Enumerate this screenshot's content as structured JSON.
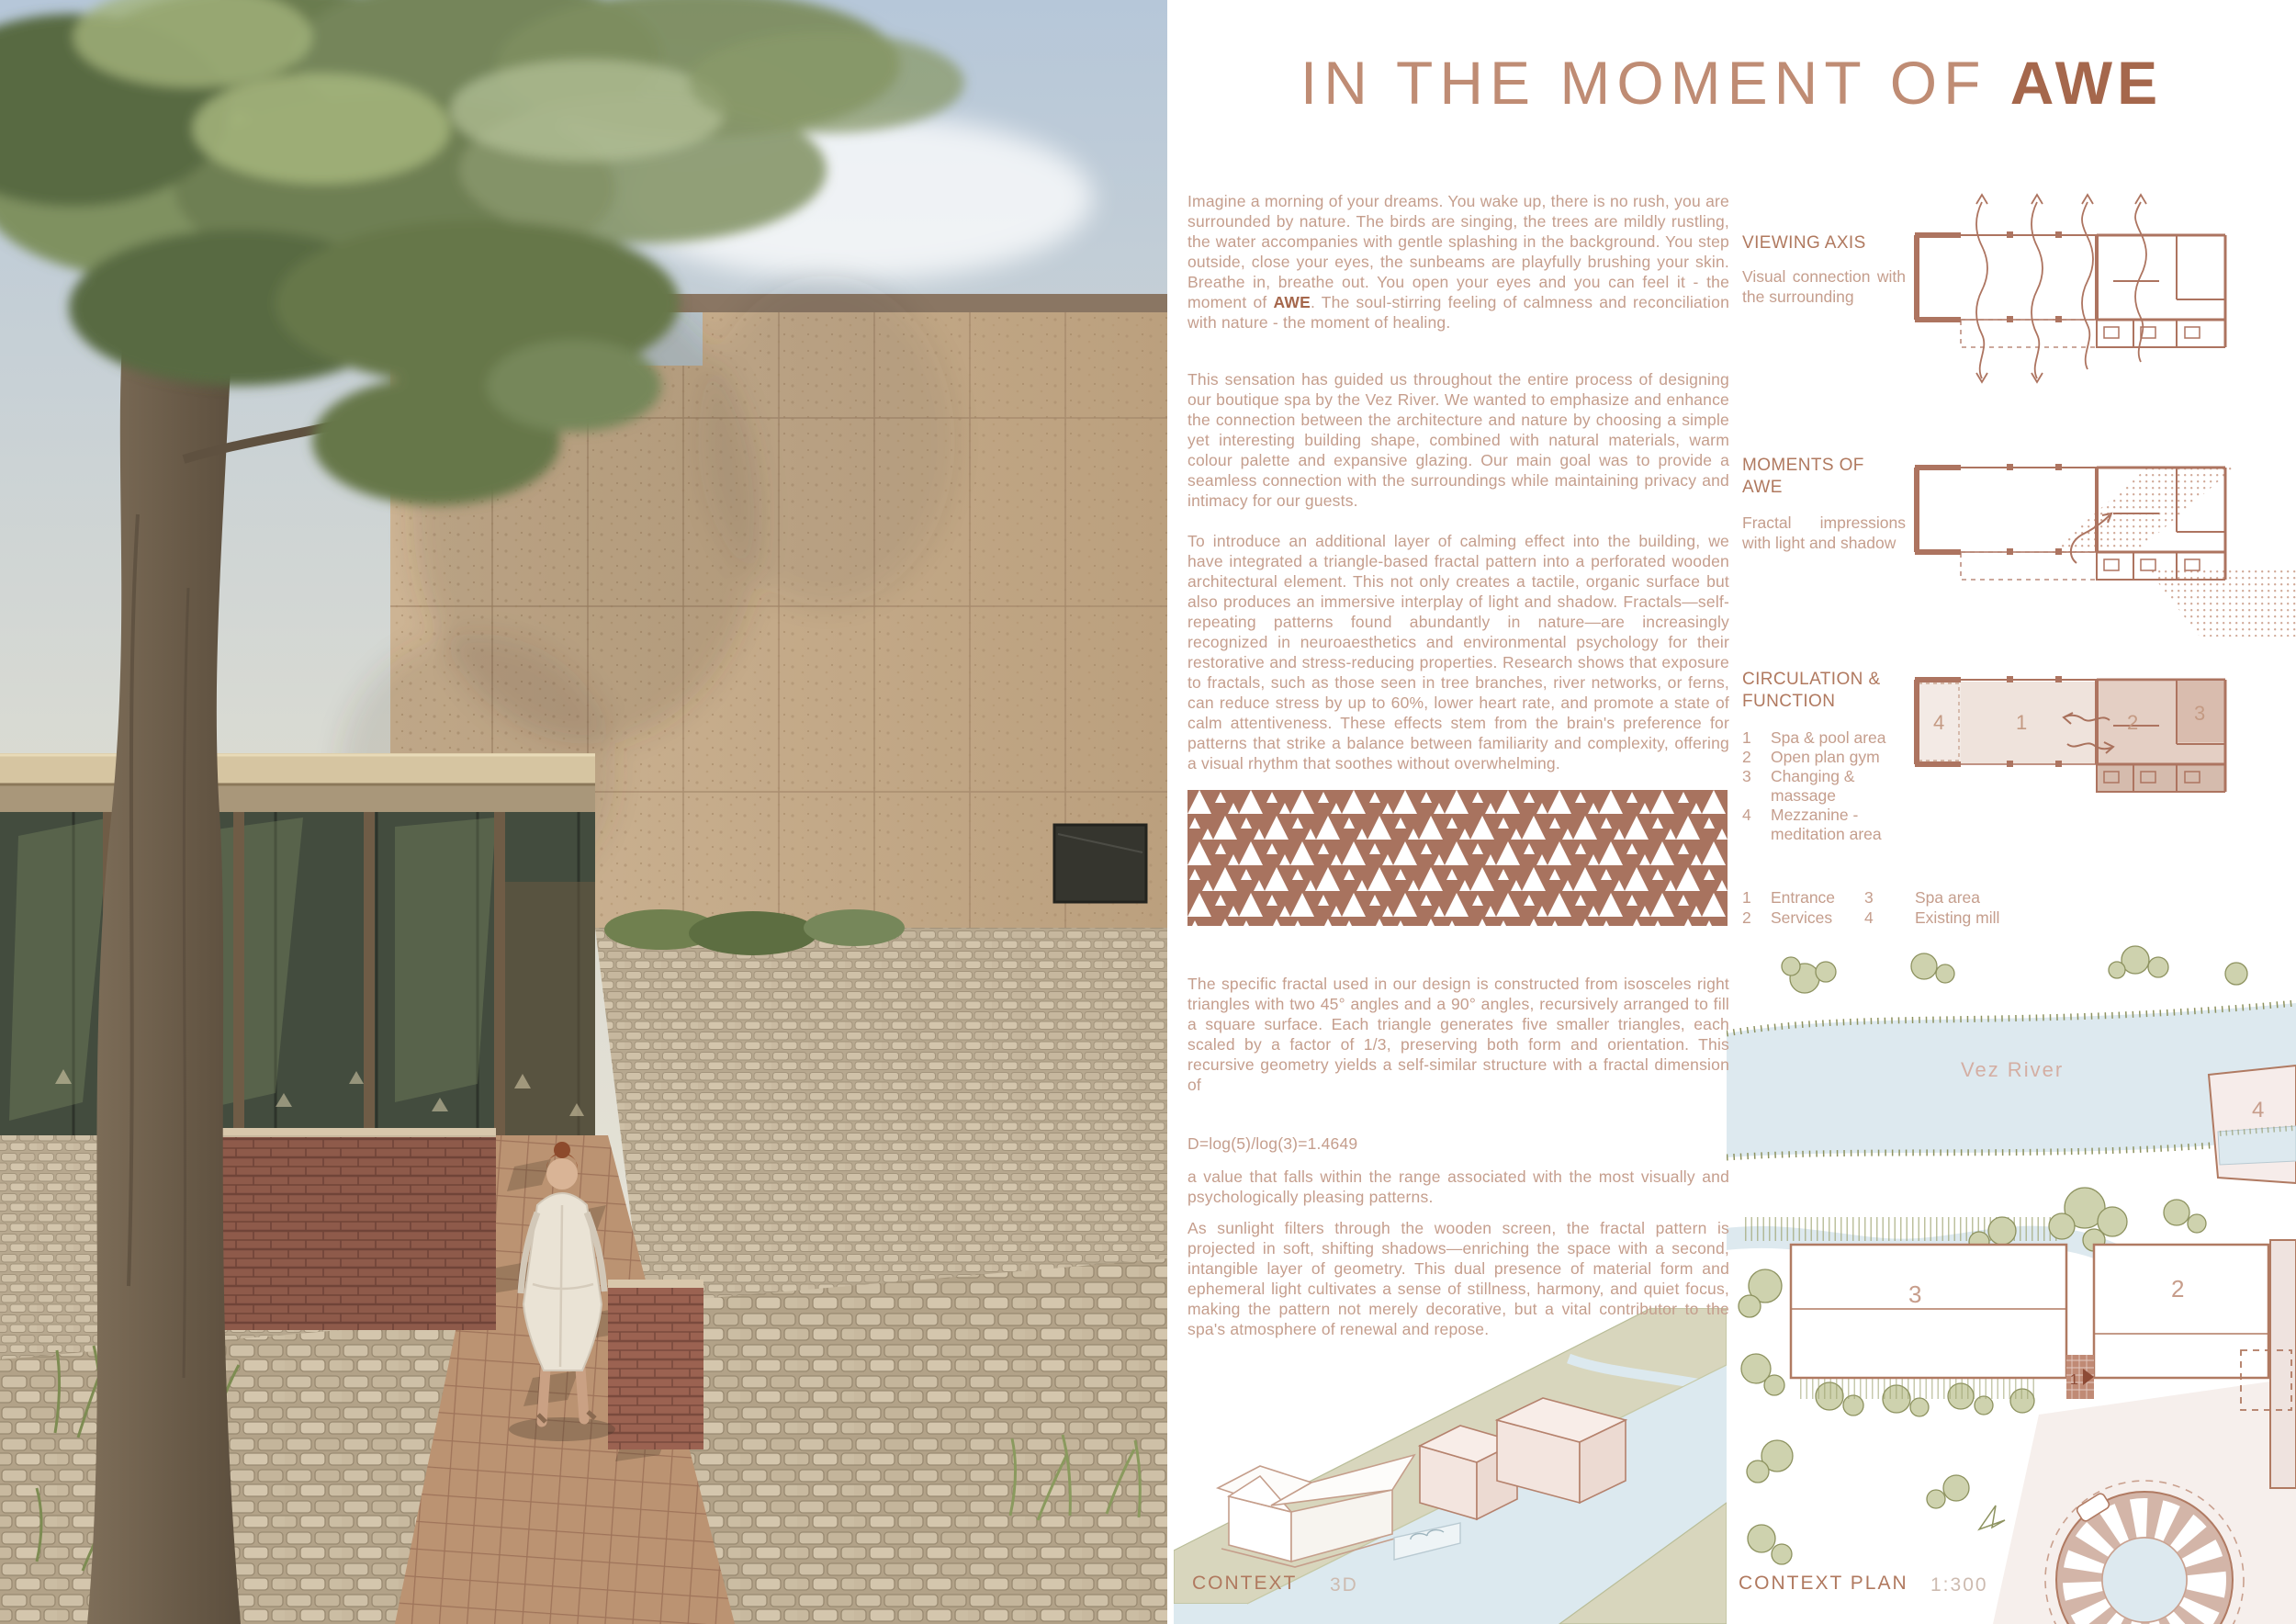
{
  "title": {
    "prefix": "IN THE MOMENT OF ",
    "accent": "AWE"
  },
  "essay": {
    "p1_before": "Imagine a morning of your dreams. You wake up, there is no rush, you are surrounded by nature. The birds are singing, the trees are mildly rustling, the water accompanies with gentle splashing in the background. You step outside, close your eyes, the sunbeams are playfully brushing your skin. Breathe in, breathe out. You open your eyes and you can feel it - the moment of ",
    "p1_awe": "AWE",
    "p1_after": ". The soul-stirring feeling of calmness and reconciliation with nature - the moment of healing.",
    "p2": "This sensation has guided us throughout the entire process of designing our boutique spa by the Vez River. We wanted to emphasize and enhance the connection between the architecture and nature by choosing a simple yet interesting building shape, combined with natural materials, warm colour palette and expansive glazing. Our main goal was to provide a seamless connection with the surroundings while maintaining privacy and intimacy for our guests.",
    "p3": "To introduce an additional layer of calming effect into the building, we have integrated a triangle-based fractal pattern into a perforated wooden architectural element. This not only creates a tactile, organic surface but also produces an immersive interplay of light and shadow. Fractals—self-repeating patterns found abundantly in nature—are increasingly recognized in neuroaesthetics and environmental psychology for their restorative and stress-reducing properties. Research shows that exposure to fractals, such as those seen in tree branches, river networks, or ferns, can reduce stress by up to 60%, lower heart rate, and promote a state of calm attentiveness. These effects stem from the brain's preference for patterns that strike a balance between familiarity and complexity, offering a visual rhythm that soothes without overwhelming.",
    "p4": "The specific fractal used in our design is constructed from isosceles right triangles with two 45° angles and a 90° angles, recursively arranged to fill a square surface. Each triangle generates five smaller triangles, each scaled by a factor of 1/3, preserving both form and orientation. This recursive geometry yields a self-similar structure with a fractal dimension of",
    "formula": "D=log(5)/log(3)=1.4649",
    "p5": "a value that falls within the range associated with the most visually and psychologically pleasing patterns.",
    "p6": "As sunlight filters through the wooden screen, the fractal pattern is projected in soft, shifting shadows—enriching the space with a second, intangible layer of geometry. This dual presence of material form and ephemeral light cultivates a sense of stillness, harmony, and quiet focus, making the pattern not merely decorative, but a vital contributor to the spa's atmosphere of renewal and repose."
  },
  "sections": {
    "viewing_axis": {
      "heading": "VIEWING AXIS",
      "body": "Visual connection with the surrounding"
    },
    "moments": {
      "heading": "MOMENTS OF AWE",
      "body": "Fractal impressions with light and shadow"
    },
    "circulation": {
      "heading": "CIRCULATION & FUNCTION",
      "items": [
        {
          "num": "1",
          "label": "Spa & pool area"
        },
        {
          "num": "2",
          "label": "Open plan gym"
        },
        {
          "num": "3",
          "label": "Changing & massage"
        },
        {
          "num": "4",
          "label": "Mezzanine - meditation area"
        }
      ]
    }
  },
  "legend": {
    "items": [
      {
        "num": "1",
        "label": "Entrance"
      },
      {
        "num": "2",
        "label": "Services"
      },
      {
        "num": "3",
        "label": "Spa area"
      },
      {
        "num": "4",
        "label": "Existing mill"
      }
    ]
  },
  "plans": {
    "circulation_rooms": [
      "4",
      "1",
      "2",
      "3"
    ]
  },
  "map": {
    "river_label": "Vez River",
    "numbers": {
      "entrance": "1",
      "gym": "2",
      "spa": "3",
      "mill": "4"
    }
  },
  "captions": {
    "context": "CONTEXT",
    "context_mode": "3D",
    "context_plan": "CONTEXT PLAN",
    "context_plan_scale": "1:300"
  },
  "colors": {
    "accent": "#ad7a63",
    "body_text": "#c59e8d",
    "pattern_brown": "#a8735f",
    "river_blue": "#dce8ee",
    "olive_land": "#d6d4ba"
  }
}
